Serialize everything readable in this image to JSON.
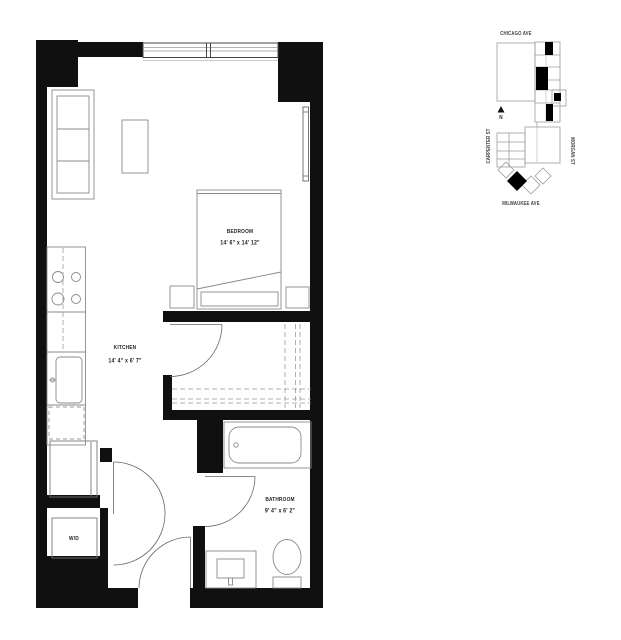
{
  "plan": {
    "rooms": {
      "bedroom": {
        "name": "BEDROOM",
        "dims": "14' 6\" x 14' 12\""
      },
      "kitchen": {
        "name": "KITCHEN",
        "dims": "14' 4\" x 6' 7\""
      },
      "bathroom": {
        "name": "BATHROOM",
        "dims": "9' 4\" x 6' 2\""
      },
      "laundry": {
        "name": "W/D"
      }
    }
  },
  "map": {
    "streets": {
      "top": "CHICAGO AVE",
      "left": "CARPENTER ST",
      "right": "MORGAN ST",
      "bottom": "MILWAUKEE AVE"
    },
    "north_label": "N"
  },
  "colors": {
    "wall": "#101010",
    "furniture_line": "#8a8a8a",
    "door_line": "#666666",
    "map_line": "#9c9c9c",
    "unit_fill": "#000000",
    "background": "#ffffff"
  }
}
